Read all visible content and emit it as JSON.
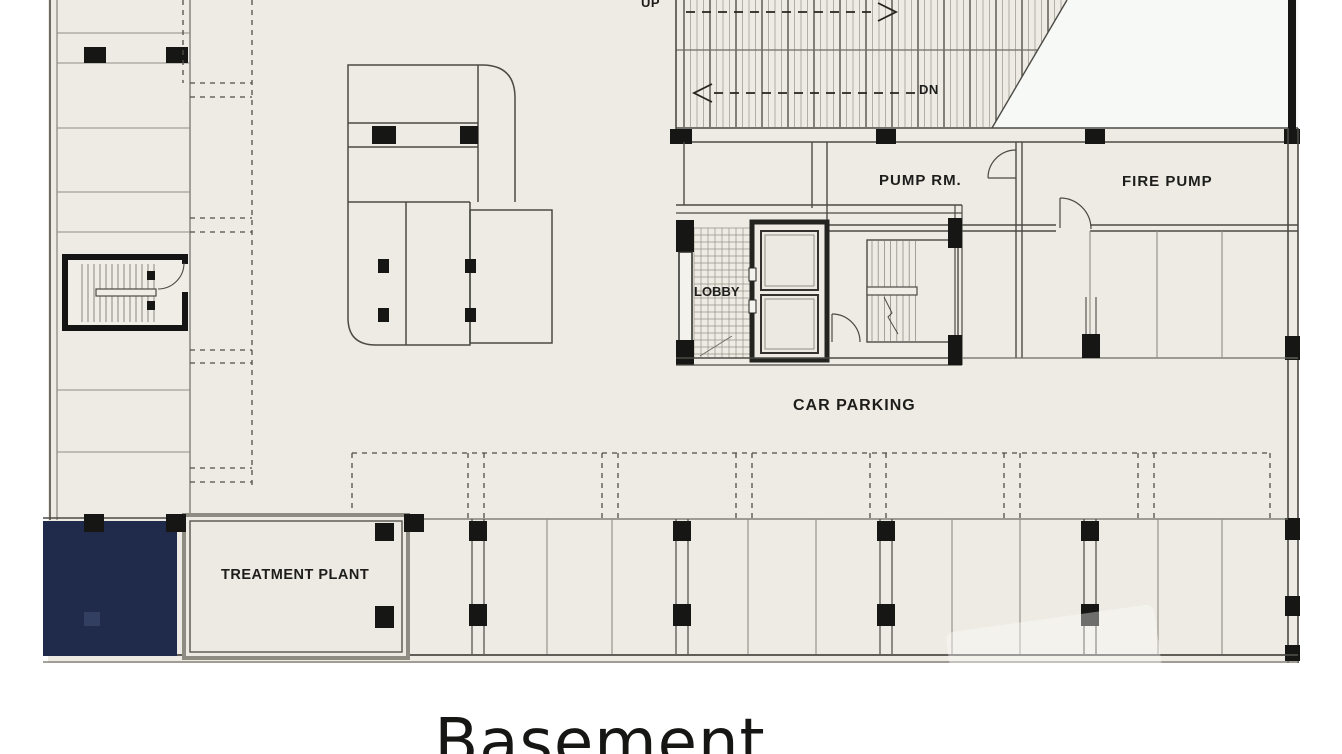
{
  "title": {
    "text": "Basement"
  },
  "labels": {
    "up": "UP",
    "dn": "DN",
    "pump_room": "PUMP RM.",
    "fire_pump": "FIRE PUMP",
    "lobby": "LOBBY",
    "car_parking": "CAR PARKING",
    "treatment_plant": "TREATMENT PLANT"
  },
  "colors": {
    "page_bg": "#ffffff",
    "plan_fill": "#edebe3",
    "outside_white": "#f7f9f6",
    "wall_dark": "#4b4a45",
    "wall_black": "#161614",
    "thin_gray": "#a39f96",
    "mid_gray": "#6e6c66",
    "tank_navy": "#202b4b",
    "ink": "#1d1d1b"
  }
}
